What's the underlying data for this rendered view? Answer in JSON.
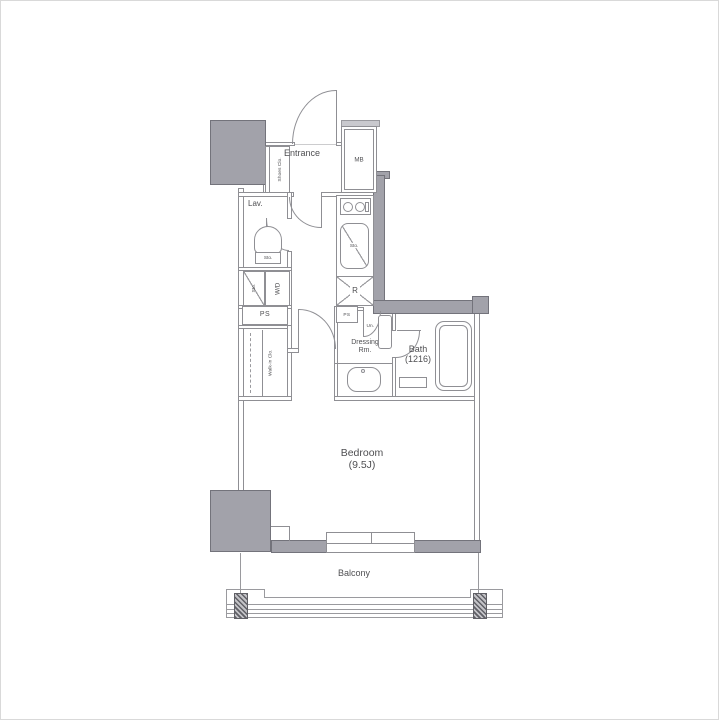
{
  "floorplan": {
    "labels": {
      "entrance": "Entrance",
      "mb": "MB",
      "shoes_closet": "Shoes Clo.",
      "lav": "Lav.",
      "sto_toilet": "Sto.",
      "sto_laundry": "Sto.",
      "washer_dryer": "W/D",
      "ps_left": "PS",
      "ps_mid": "PS",
      "sto_kitchen": "Sto.",
      "refrigerator": "R",
      "walk_in_closet": "Walk-in Clo.",
      "dressing_room_line1": "Dressing",
      "dressing_room_line2": "Rm.",
      "unit": "Un.",
      "bath": "Bath",
      "bath_size": "(1216)",
      "bedroom": "Bedroom",
      "bedroom_size": "(9.5J)",
      "balcony": "Balcony"
    },
    "colors": {
      "structural_wall_fill": "#a2a2aa",
      "wall_line": "#8f8f94",
      "text": "#4f4f52",
      "background": "#ffffff"
    }
  }
}
